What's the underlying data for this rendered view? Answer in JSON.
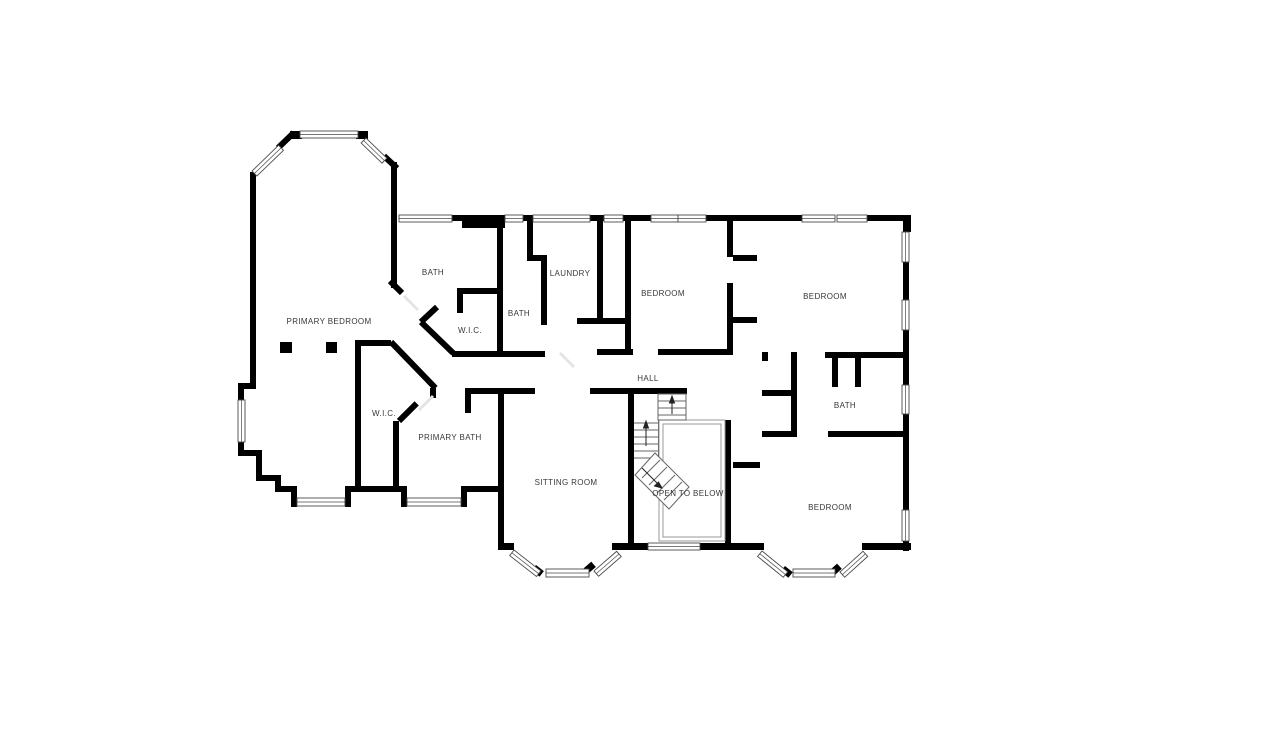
{
  "title": "Second floor plan",
  "colors": {
    "wall": "#000000",
    "label": "#383838",
    "stair": "#666666",
    "void_outline": "#999999",
    "window_frame": "#4a4a4a",
    "door_leaf": "#e4e4e4",
    "background": "#ffffff"
  },
  "rooms": [
    {
      "id": "primary-bedroom",
      "label": "PRIMARY BEDROOM"
    },
    {
      "id": "bath-top",
      "label": "BATH"
    },
    {
      "id": "wic-upper",
      "label": "W.I.C."
    },
    {
      "id": "bath-center",
      "label": "BATH"
    },
    {
      "id": "laundry",
      "label": "LAUNDRY"
    },
    {
      "id": "bedroom-top-center",
      "label": "BEDROOM"
    },
    {
      "id": "bedroom-top-right",
      "label": "BEDROOM"
    },
    {
      "id": "hall",
      "label": "HALL"
    },
    {
      "id": "bath-right",
      "label": "BATH"
    },
    {
      "id": "wic-left",
      "label": "W.I.C."
    },
    {
      "id": "primary-bath",
      "label": "PRIMARY BATH"
    },
    {
      "id": "sitting-room",
      "label": "SITTING ROOM"
    },
    {
      "id": "open-to-below",
      "label": "OPEN TO BELOW"
    },
    {
      "id": "bedroom-bottom-right",
      "label": "BEDROOM"
    }
  ]
}
